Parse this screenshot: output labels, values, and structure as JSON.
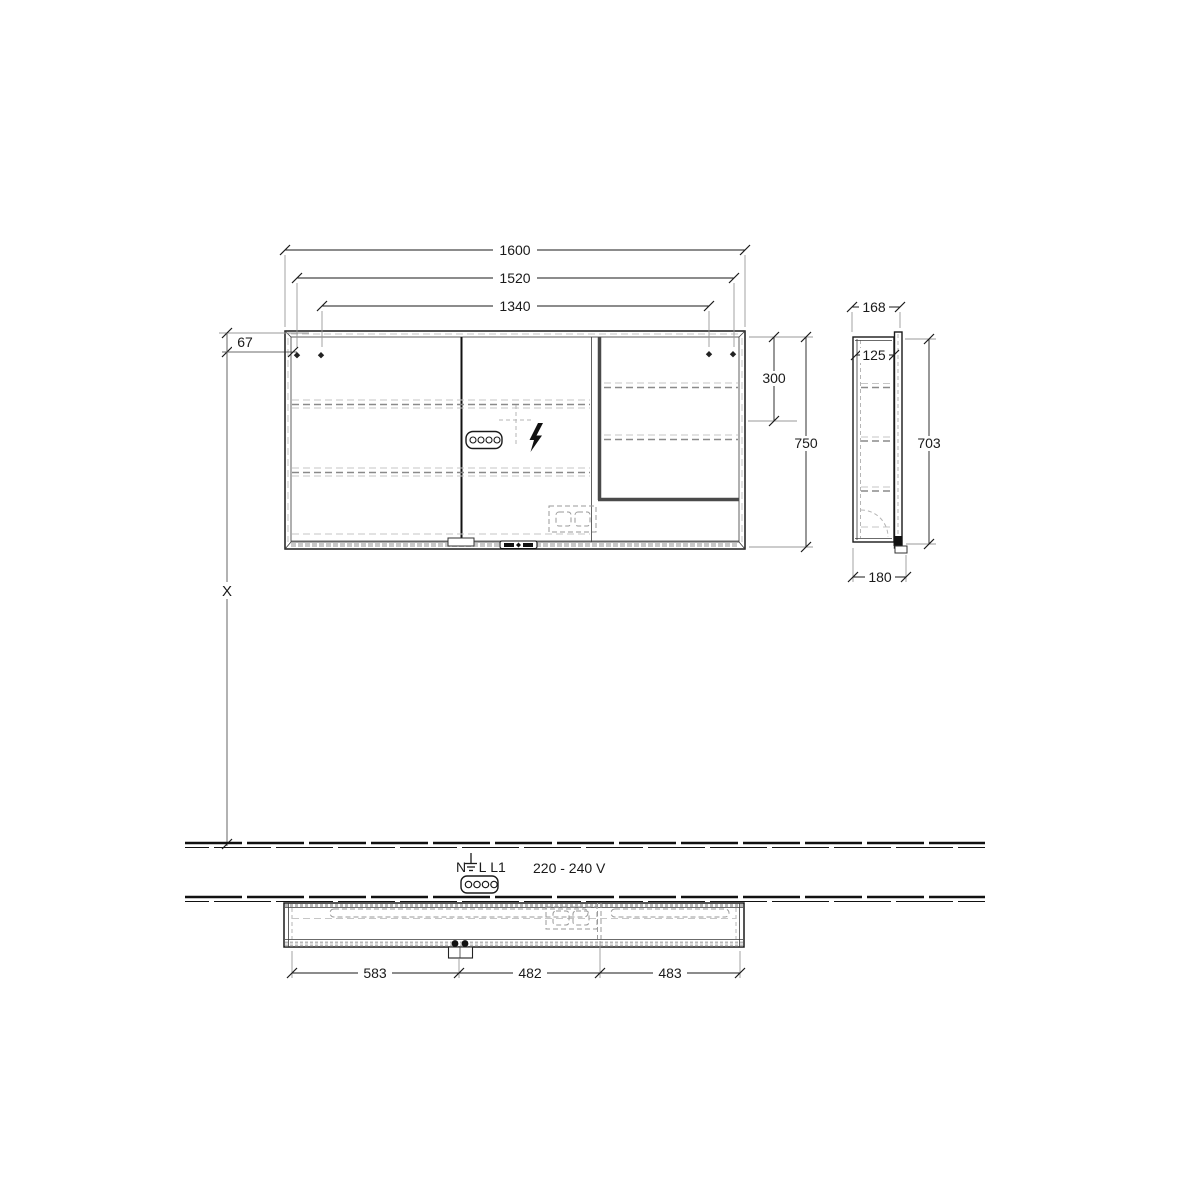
{
  "front": {
    "dim_total_width": "1600",
    "dim_hole_span_outer": "1520",
    "dim_hole_span_inner": "1340",
    "dim_hole_top_offset": "67",
    "dim_right_section_height": "300",
    "dim_height": "750",
    "dim_mount_ref": "X"
  },
  "side": {
    "dim_depth": "168",
    "dim_inner_depth": "125",
    "dim_door_height": "703",
    "dim_depth_bottom": "180"
  },
  "plan": {
    "dim_left": "583",
    "dim_mid": "482",
    "dim_right": "483"
  },
  "electrical": {
    "terminal_n": "N",
    "terminal_l": "L",
    "terminal_l1": "L1",
    "voltage": "220 - 240 V"
  },
  "colors": {
    "line": "#1a1a1a",
    "extension": "#999999",
    "dashed_light": "#c6c6c6",
    "dashed_dark": "#8a8a8a",
    "background": "#ffffff"
  }
}
